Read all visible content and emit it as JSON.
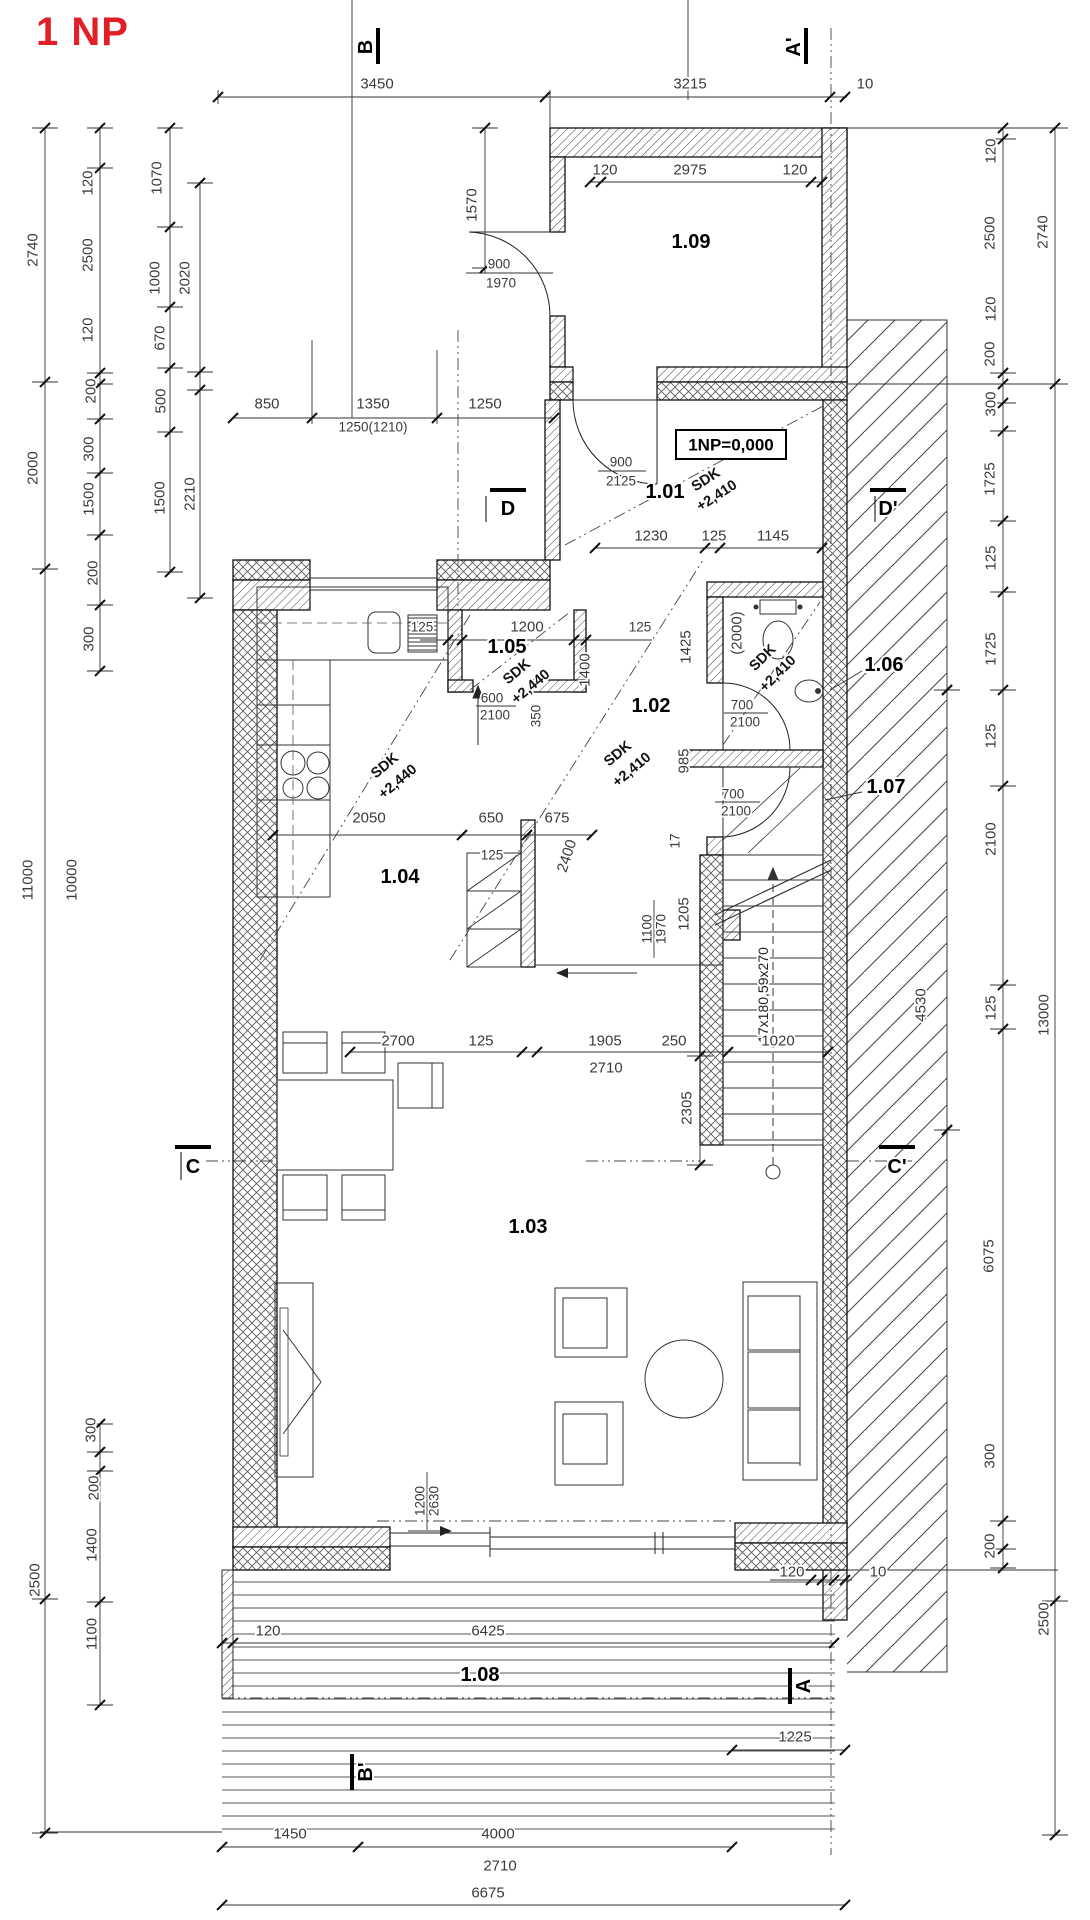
{
  "title": "1 NP",
  "accent": "#e01f26",
  "level_note": "1NP=0,000",
  "stair_note": "17x180,59x270",
  "rooms": [
    {
      "t": "1.01",
      "x": 665,
      "y": 492
    },
    {
      "t": "1.02",
      "x": 651,
      "y": 706
    },
    {
      "t": "1.03",
      "x": 528,
      "y": 1227
    },
    {
      "t": "1.04",
      "x": 400,
      "y": 877
    },
    {
      "t": "1.05",
      "x": 507,
      "y": 647
    },
    {
      "t": "1.06",
      "x": 884,
      "y": 665
    },
    {
      "t": "1.07",
      "x": 886,
      "y": 787
    },
    {
      "t": "1.08",
      "x": 480,
      "y": 1675
    },
    {
      "t": "1.09",
      "x": 691,
      "y": 242
    }
  ],
  "sections": [
    {
      "t": "B",
      "x": 366,
      "y": 47,
      "r": -90
    },
    {
      "t": "A'",
      "x": 794,
      "y": 47,
      "r": -90
    },
    {
      "t": "D",
      "x": 508,
      "y": 509,
      "r": 0
    },
    {
      "t": "D'",
      "x": 888,
      "y": 509,
      "r": 0
    },
    {
      "t": "C",
      "x": 193,
      "y": 1167,
      "r": 0
    },
    {
      "t": "C'",
      "x": 897,
      "y": 1167,
      "r": 0
    },
    {
      "t": "B'",
      "x": 366,
      "y": 1772,
      "r": -90
    },
    {
      "t": "A",
      "x": 804,
      "y": 1686,
      "r": -90
    }
  ],
  "dims": [
    {
      "t": "3450",
      "x": 377,
      "y": 84
    },
    {
      "t": "3215",
      "x": 690,
      "y": 84
    },
    {
      "t": "10",
      "x": 865,
      "y": 84
    },
    {
      "t": "1570",
      "x": 472,
      "y": 205,
      "r": -90
    },
    {
      "t": "120",
      "x": 605,
      "y": 170
    },
    {
      "t": "2975",
      "x": 690,
      "y": 170
    },
    {
      "t": "120",
      "x": 795,
      "y": 170
    },
    {
      "t": "900",
      "x": 499,
      "y": 264,
      "s": 1
    },
    {
      "t": "1970",
      "x": 501,
      "y": 283,
      "s": 1
    },
    {
      "t": "2740",
      "x": 33,
      "y": 250,
      "r": -90
    },
    {
      "t": "120",
      "x": 88,
      "y": 183,
      "r": -90
    },
    {
      "t": "2500",
      "x": 88,
      "y": 255,
      "r": -90
    },
    {
      "t": "120",
      "x": 88,
      "y": 330,
      "r": -90
    },
    {
      "t": "1070",
      "x": 157,
      "y": 178,
      "r": -90
    },
    {
      "t": "1000",
      "x": 155,
      "y": 278,
      "r": -90
    },
    {
      "t": "2020",
      "x": 185,
      "y": 278,
      "r": -90
    },
    {
      "t": "670",
      "x": 160,
      "y": 338,
      "r": -90
    },
    {
      "t": "200",
      "x": 91,
      "y": 391,
      "r": -90
    },
    {
      "t": "500",
      "x": 161,
      "y": 401,
      "r": -90
    },
    {
      "t": "300",
      "x": 89,
      "y": 449,
      "r": -90
    },
    {
      "t": "2000",
      "x": 33,
      "y": 468,
      "r": -90
    },
    {
      "t": "1500",
      "x": 89,
      "y": 499,
      "r": -90
    },
    {
      "t": "1500",
      "x": 160,
      "y": 498,
      "r": -90
    },
    {
      "t": "2210",
      "x": 190,
      "y": 494,
      "r": -90
    },
    {
      "t": "200",
      "x": 93,
      "y": 573,
      "r": -90
    },
    {
      "t": "300",
      "x": 89,
      "y": 639,
      "r": -90
    },
    {
      "t": "11000",
      "x": 28,
      "y": 880,
      "r": -90
    },
    {
      "t": "10000",
      "x": 72,
      "y": 880,
      "r": -90
    },
    {
      "t": "300",
      "x": 91,
      "y": 1430,
      "r": -90
    },
    {
      "t": "200",
      "x": 94,
      "y": 1488,
      "r": -90
    },
    {
      "t": "1400",
      "x": 92,
      "y": 1545,
      "r": -90
    },
    {
      "t": "2500",
      "x": 35,
      "y": 1580,
      "r": -90
    },
    {
      "t": "1100",
      "x": 92,
      "y": 1634,
      "r": -90
    },
    {
      "t": "850",
      "x": 267,
      "y": 404
    },
    {
      "t": "1350",
      "x": 373,
      "y": 404
    },
    {
      "t": "1250",
      "x": 485,
      "y": 404
    },
    {
      "t": "1250(1210)",
      "x": 373,
      "y": 427,
      "s": 1
    },
    {
      "t": "900",
      "x": 621,
      "y": 462,
      "s": 1
    },
    {
      "t": "2125",
      "x": 621,
      "y": 481,
      "s": 1
    },
    {
      "t": "1230",
      "x": 651,
      "y": 536
    },
    {
      "t": "125",
      "x": 714,
      "y": 536
    },
    {
      "t": "1145",
      "x": 773,
      "y": 536
    },
    {
      "t": "125",
      "x": 422,
      "y": 627,
      "s": 1
    },
    {
      "t": "1200",
      "x": 527,
      "y": 627
    },
    {
      "t": "125",
      "x": 640,
      "y": 627,
      "s": 1
    },
    {
      "t": "600",
      "x": 492,
      "y": 698,
      "s": 1
    },
    {
      "t": "2100",
      "x": 495,
      "y": 715,
      "s": 1
    },
    {
      "t": "350",
      "x": 536,
      "y": 716,
      "r": -90,
      "s": 1
    },
    {
      "t": "1425",
      "x": 686,
      "y": 647,
      "r": -90
    },
    {
      "t": "1400",
      "x": 585,
      "y": 670,
      "r": -90
    },
    {
      "t": "(2000)",
      "x": 737,
      "y": 633,
      "r": -90
    },
    {
      "t": "700",
      "x": 742,
      "y": 705,
      "s": 1
    },
    {
      "t": "2100",
      "x": 745,
      "y": 722,
      "s": 1
    },
    {
      "t": "700",
      "x": 733,
      "y": 794,
      "s": 1
    },
    {
      "t": "2100",
      "x": 736,
      "y": 811,
      "s": 1
    },
    {
      "t": "2050",
      "x": 369,
      "y": 818
    },
    {
      "t": "650",
      "x": 491,
      "y": 818
    },
    {
      "t": "675",
      "x": 557,
      "y": 818
    },
    {
      "t": "125",
      "x": 492,
      "y": 855,
      "s": 1
    },
    {
      "t": "2400",
      "x": 567,
      "y": 856,
      "r": -72
    },
    {
      "t": "985",
      "x": 684,
      "y": 761,
      "r": -90
    },
    {
      "t": "17",
      "x": 675,
      "y": 841,
      "r": -90,
      "s": 1
    },
    {
      "t": "1205",
      "x": 684,
      "y": 914,
      "r": -90
    },
    {
      "t": "1100",
      "x": 647,
      "y": 929,
      "r": -90,
      "s": 1
    },
    {
      "t": "1970",
      "x": 661,
      "y": 929,
      "r": -90,
      "s": 1
    },
    {
      "t": "2700",
      "x": 398,
      "y": 1041
    },
    {
      "t": "125",
      "x": 481,
      "y": 1041
    },
    {
      "t": "1905",
      "x": 605,
      "y": 1041
    },
    {
      "t": "250",
      "x": 674,
      "y": 1041
    },
    {
      "t": "1020",
      "x": 778,
      "y": 1041
    },
    {
      "t": "2710",
      "x": 606,
      "y": 1068
    },
    {
      "t": "2305",
      "x": 687,
      "y": 1108,
      "r": -90
    },
    {
      "t": "4530",
      "x": 921,
      "y": 1005,
      "r": -90
    },
    {
      "t": "120",
      "x": 991,
      "y": 151,
      "r": -90
    },
    {
      "t": "2500",
      "x": 990,
      "y": 233,
      "r": -90
    },
    {
      "t": "2740",
      "x": 1043,
      "y": 232,
      "r": -90
    },
    {
      "t": "120",
      "x": 991,
      "y": 309,
      "r": -90
    },
    {
      "t": "200",
      "x": 990,
      "y": 354,
      "r": -90
    },
    {
      "t": "300",
      "x": 991,
      "y": 404,
      "r": -90
    },
    {
      "t": "1725",
      "x": 990,
      "y": 479,
      "r": -90
    },
    {
      "t": "125",
      "x": 991,
      "y": 558,
      "r": -90
    },
    {
      "t": "1725",
      "x": 991,
      "y": 649,
      "r": -90
    },
    {
      "t": "125",
      "x": 991,
      "y": 736,
      "r": -90
    },
    {
      "t": "2100",
      "x": 991,
      "y": 839,
      "r": -90
    },
    {
      "t": "125",
      "x": 991,
      "y": 1008,
      "r": -90
    },
    {
      "t": "13000",
      "x": 1044,
      "y": 1015,
      "r": -90
    },
    {
      "t": "6075",
      "x": 989,
      "y": 1256,
      "r": -90
    },
    {
      "t": "300",
      "x": 990,
      "y": 1456,
      "r": -90
    },
    {
      "t": "200",
      "x": 990,
      "y": 1546,
      "r": -90
    },
    {
      "t": "2500",
      "x": 1044,
      "y": 1619,
      "r": -90
    },
    {
      "t": "1200",
      "x": 420,
      "y": 1501,
      "r": -90,
      "s": 1
    },
    {
      "t": "2630",
      "x": 434,
      "y": 1501,
      "r": -90,
      "s": 1
    },
    {
      "t": "120",
      "x": 268,
      "y": 1631
    },
    {
      "t": "6425",
      "x": 488,
      "y": 1631
    },
    {
      "t": "120",
      "x": 792,
      "y": 1572
    },
    {
      "t": "10",
      "x": 878,
      "y": 1572
    },
    {
      "t": "1450",
      "x": 290,
      "y": 1834
    },
    {
      "t": "4000",
      "x": 498,
      "y": 1834
    },
    {
      "t": "1225",
      "x": 795,
      "y": 1737
    },
    {
      "t": "2710",
      "x": 500,
      "y": 1866
    },
    {
      "t": "6675",
      "x": 488,
      "y": 1893
    }
  ],
  "notes": [
    {
      "t": "SDK",
      "x": 706,
      "y": 480,
      "r": -33
    },
    {
      "t": "+2,410",
      "x": 717,
      "y": 496,
      "r": -33
    },
    {
      "t": "SDK",
      "x": 385,
      "y": 766,
      "r": -40
    },
    {
      "t": "+2,440",
      "x": 398,
      "y": 782,
      "r": -40
    },
    {
      "t": "SDK",
      "x": 517,
      "y": 672,
      "r": -40
    },
    {
      "t": "+2,440",
      "x": 531,
      "y": 687,
      "r": -40
    },
    {
      "t": "SDK",
      "x": 618,
      "y": 754,
      "r": -40
    },
    {
      "t": "+2,410",
      "x": 632,
      "y": 770,
      "r": -40
    },
    {
      "t": "SDK",
      "x": 763,
      "y": 658,
      "r": -45
    },
    {
      "t": "+2,410",
      "x": 778,
      "y": 674,
      "r": -45
    }
  ]
}
